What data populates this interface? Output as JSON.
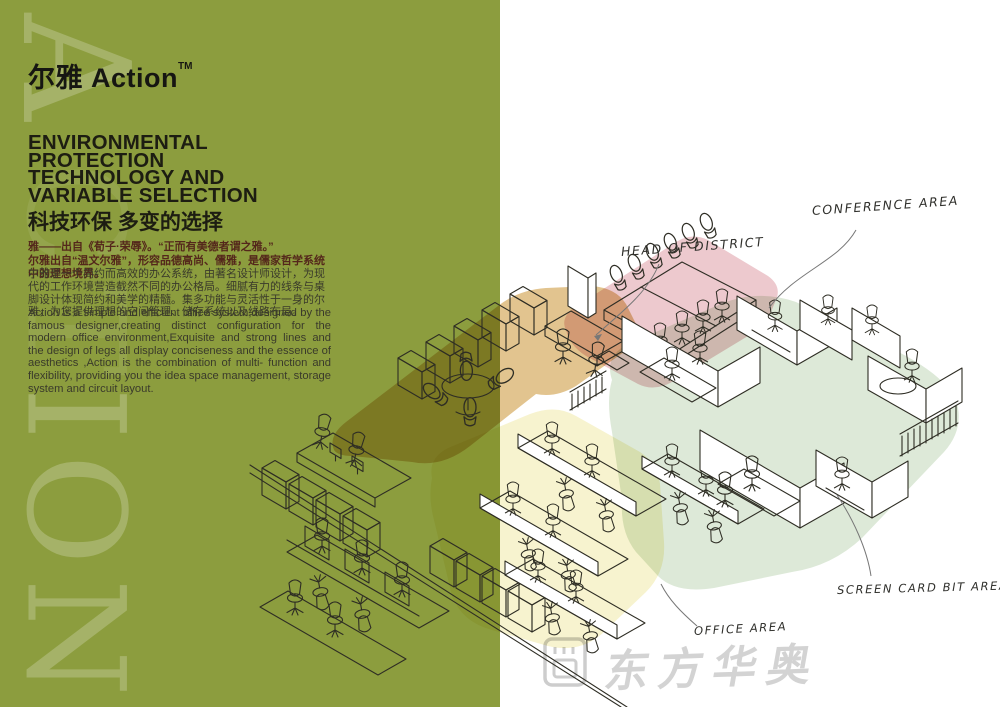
{
  "left_panel": {
    "bg_color": "#8C9D3E",
    "watermark_letters": [
      "A",
      "C",
      "T",
      "I",
      "O",
      "N"
    ],
    "brand": {
      "title": "尔雅 Action",
      "trademark": "TM"
    },
    "heading_lines": [
      "ENVIRONMENTAL",
      "PROTECTION",
      "TECHNOLOGY AND",
      "VARIABLE SELECTION"
    ],
    "heading_cn": "科技环保  多变的选择",
    "intro_lines": [
      "雅——出自《荀子·荣辱》。“正而有美德者谓之雅。”",
      "尔雅出自“温文尔雅”，形容品德高尚、儒雅，是儒家哲学系统中的理想境界。"
    ],
    "body_cn": "尔雅是一个简约而高效的办公系统，由著名设计师设计，为现代的工作环境营造截然不同的办公格局。细腻有力的线条与桌脚设计体现简约和美学的精髓。集多功能与灵活性于一身的尔雅，为您提供理想的空间管理、储存系统以及线路布局。",
    "body_en": "Action is a simple and efficient office system,designed by the famous designer,creating distinct configuration for the modern office environment,Exquisite and strong lines and the design of legs all display conciseness and the essence of aesthetics ,Action is the combination of multi- function and flexibility, providing you the idea space management, storage system and circuit layout."
  },
  "floorplan": {
    "labels": [
      {
        "id": "head-of-district",
        "text": "HEAD OF DISTRICT"
      },
      {
        "id": "conference-area",
        "text": "CONFERENCE AREA"
      },
      {
        "id": "screen-card-bit-area",
        "text": "SCREEN CARD BIT AREA"
      },
      {
        "id": "office-area",
        "text": "OFFICE AREA"
      }
    ],
    "zone_colors": {
      "head_of_district": "#E2C48F",
      "conference": "#EDC9CE",
      "screen_card": "#DDE9D8",
      "office": "#F7F3CF"
    }
  },
  "watermark_logo": {
    "text": "东方华奥"
  }
}
